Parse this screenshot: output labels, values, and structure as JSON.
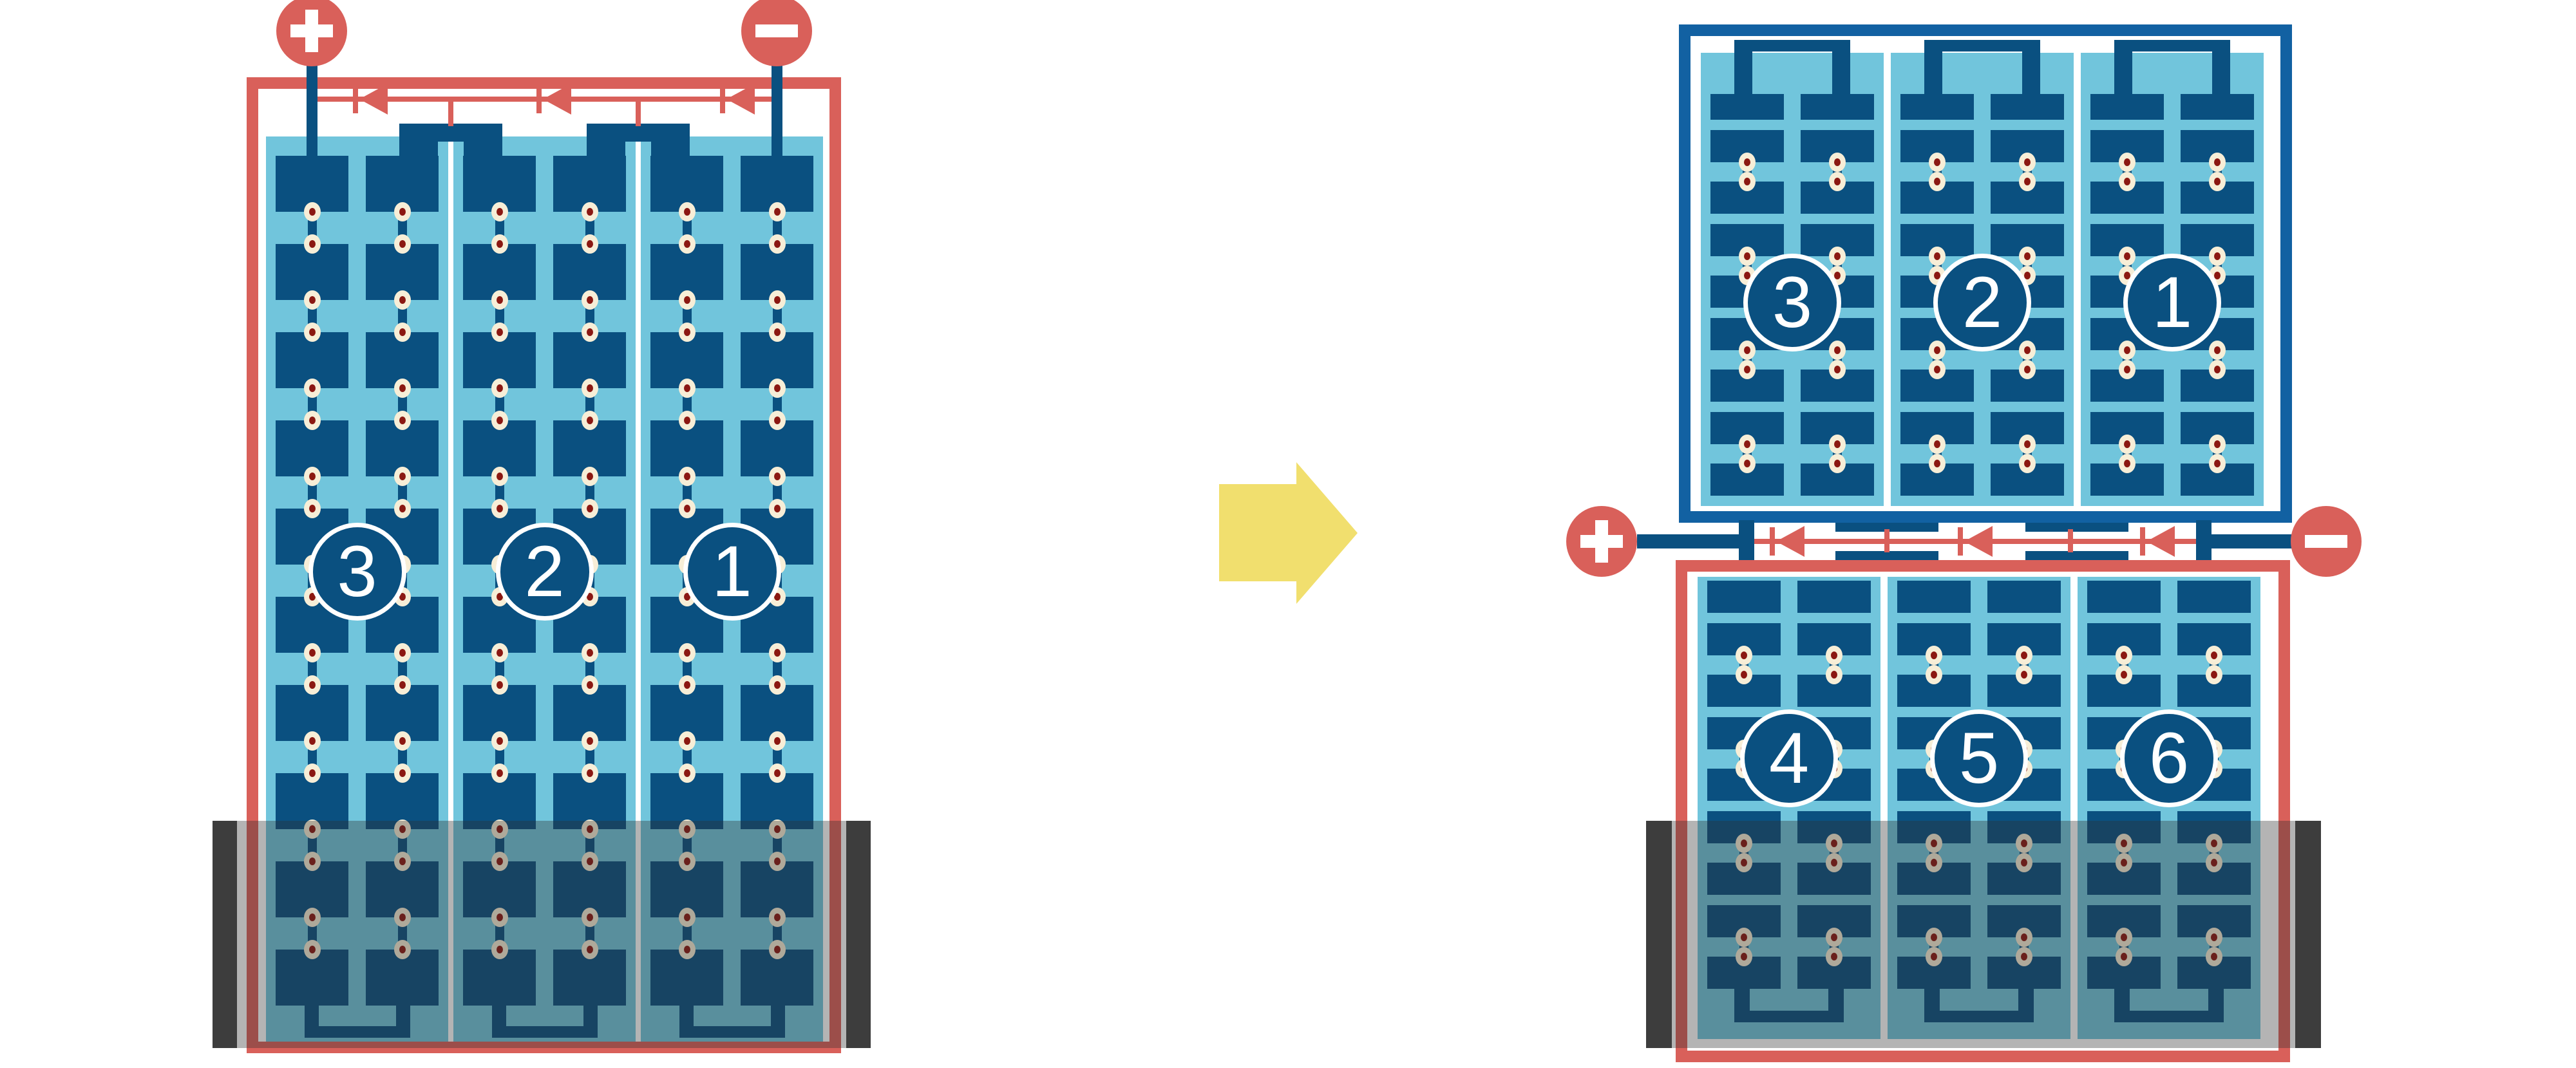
{
  "scene": {
    "description": "Solar module string wiring comparison: standard full-cell module with top junction (left) transforms into a half-cut module with two half-panels and a centered junction (right)"
  },
  "colors": {
    "module_red": "#d9605a",
    "cell_navy": "#0a5080",
    "frame_blue": "#1261a2",
    "cell_field_blue": "#71c5dc",
    "solder_cream": "#f7eed7",
    "solder_maroon": "#8b1812",
    "shade_overlay": "rgba(47,47,47,0.36)",
    "shade_bar": "#3d3d3d",
    "arrow_yellow": "#f1df6e",
    "background": "#ffffff",
    "label_white": "#ffffff"
  },
  "left_module": {
    "terminals": {
      "positive_symbol": "+",
      "negative_symbol": "-"
    },
    "bypass_diodes": 3,
    "cell_strings": [
      {
        "label": "3"
      },
      {
        "label": "2"
      },
      {
        "label": "1"
      }
    ],
    "cell_rows": 10,
    "columns_per_string": 2,
    "bottom_shaded": true
  },
  "transition_arrow": {
    "direction": "right"
  },
  "right_modules": {
    "terminals": {
      "positive_symbol": "+",
      "negative_symbol": "-"
    },
    "bypass_diodes": 3,
    "top": {
      "cell_strings": [
        {
          "label": "3"
        },
        {
          "label": "2"
        },
        {
          "label": "1"
        }
      ],
      "cell_rows": 9,
      "bottom_shaded": false
    },
    "bottom": {
      "cell_strings": [
        {
          "label": "4"
        },
        {
          "label": "5"
        },
        {
          "label": "6"
        }
      ],
      "cell_rows": 9,
      "bottom_shaded": true
    }
  }
}
